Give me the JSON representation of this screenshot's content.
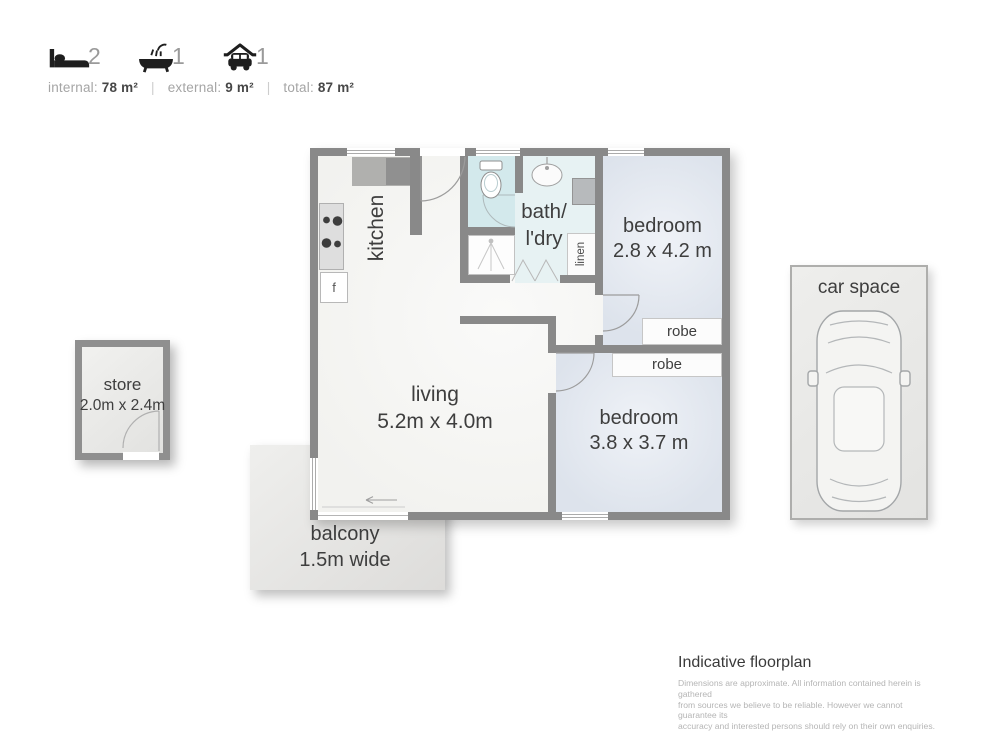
{
  "header": {
    "bed": {
      "icon": "bed-icon",
      "count": "2"
    },
    "bath": {
      "icon": "bath-icon",
      "count": "1"
    },
    "car": {
      "icon": "garage-icon",
      "count": "1"
    },
    "areas": {
      "internal_label": "internal:",
      "internal_value": "78 m²",
      "external_label": "external:",
      "external_value": "9 m²",
      "total_label": "total:",
      "total_value": "87 m²",
      "separator": "|"
    }
  },
  "floorplan": {
    "kitchen": {
      "label": "kitchen",
      "fridge_label": "f"
    },
    "bath_laundry": {
      "line1": "bath/",
      "line2": "l'dry",
      "linen_label": "linen"
    },
    "bedroom_1": {
      "label": "bedroom",
      "dimensions": "2.8 x 4.2 m",
      "robe_label": "robe"
    },
    "bedroom_2": {
      "label": "bedroom",
      "dimensions": "3.8 x 3.7 m",
      "robe_label": "robe"
    },
    "living": {
      "label": "living",
      "dimensions": "5.2m x 4.0m"
    },
    "balcony": {
      "label": "balcony",
      "dimensions": "1.5m wide"
    },
    "store": {
      "label": "store",
      "dimensions": "2.0m x 2.4m"
    },
    "car_space": {
      "label": "car space"
    }
  },
  "footer": {
    "title": "Indicative floorplan",
    "disclaimer": [
      "Dimensions are approximate.  All information contained herein is gathered",
      "from sources we believe to be reliable.  However we cannot guarantee its",
      "accuracy and interested persons should rely on their own enquiries."
    ]
  },
  "colors": {
    "wall": "#898989",
    "bedroom_fill": "#e1e6ed",
    "bath_fill": "#e7f2f3",
    "toilet_fill": "#d3e9ec",
    "outdoor_fill": "#e8e8e6",
    "text_dark": "#3e3e3e",
    "count_muted": "#9a9a9a",
    "disclaimer_muted": "#b5b5b5"
  }
}
